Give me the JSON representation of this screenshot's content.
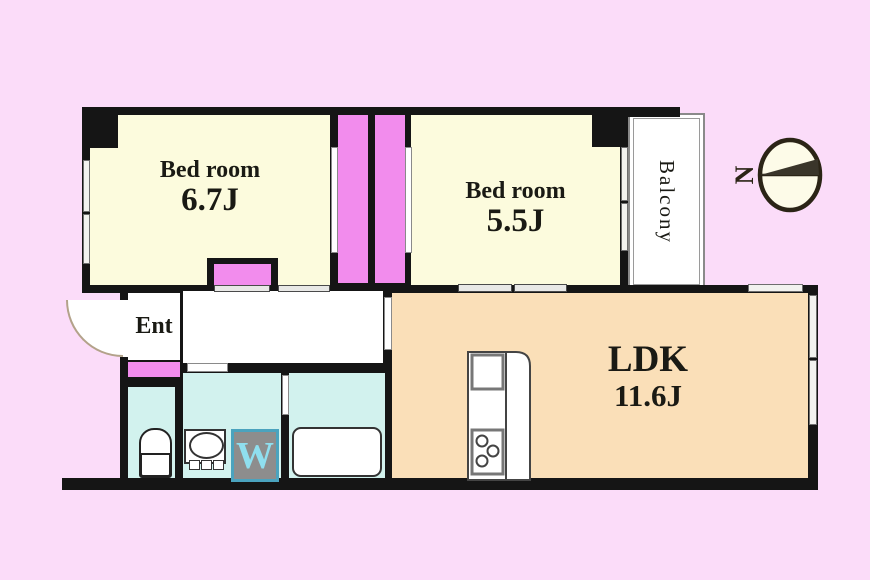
{
  "rooms": {
    "bedroom1": {
      "name": "Bed room",
      "size": "6.7J"
    },
    "bedroom2": {
      "name": "Bed room",
      "size": "5.5J"
    },
    "ldk": {
      "name": "LDK",
      "size": "11.6J"
    },
    "entrance": {
      "name": "Ent"
    },
    "balcony": {
      "name": "Balcony"
    }
  },
  "symbols": {
    "washer_letter": "W",
    "compass_north": "N"
  },
  "colors": {
    "background": "#fbdcf9",
    "wall": "#151515",
    "bedroom_fill": "#fcfbdd",
    "closet_fill": "#f28ced",
    "ldk_fill": "#fadfb8",
    "wet_fill": "#d2f2ee",
    "washer_box": "#8d8d8d",
    "washer_letter": "#8fdfef",
    "washer_border": "#4ba3be"
  }
}
